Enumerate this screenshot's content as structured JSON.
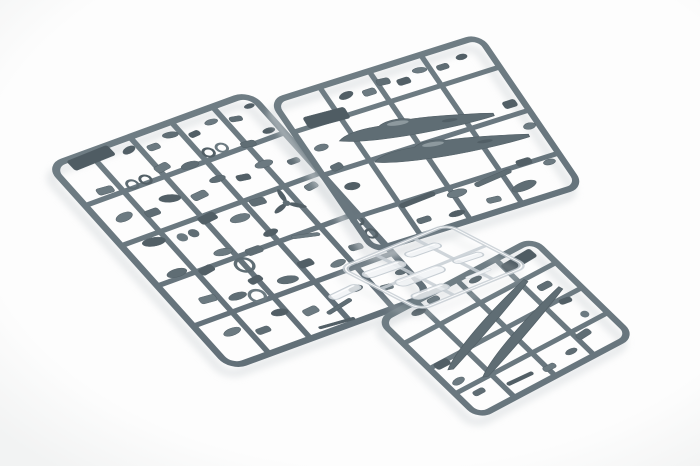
{
  "image": {
    "kind": "photograph",
    "subject": "injection-molded plastic scale-model aircraft kit sprues on a white studio background",
    "width": 700,
    "height": 466
  },
  "palette": {
    "bg_center": "#fdfdfd",
    "bg_edge": "#f2f3f3",
    "runner_top": "#6f7d84",
    "runner_bottom": "#596670",
    "part": "#5f6d74",
    "part_dark": "#525f66",
    "part_light": "#6c7a81",
    "tab": "#4f5c63",
    "accent_light": "#8d999e",
    "clear_stroke": "#c7ced4",
    "clear_fill": "#f0f3f5",
    "clear_highlight": "#ffffff",
    "shadow": "#d7dbde"
  },
  "sprues": [
    {
      "name": "sprue-a-detail-parts",
      "material": "grey-styrene",
      "matrix": [
        0.94,
        -0.344,
        0.668,
        0.744,
        45,
        165
      ],
      "frame": {
        "w": 218,
        "h": 277,
        "rx": 14,
        "stroke": 7
      },
      "runners": {
        "v": [
          44,
          88,
          132,
          176
        ],
        "h": [
          56,
          110,
          164,
          218
        ]
      },
      "parts": [
        [
          "tab",
          42,
          10,
          44,
          13,
          -2
        ],
        [
          "ell",
          78,
          16,
          14,
          7,
          -15
        ],
        [
          "rect",
          100,
          22,
          12,
          7,
          0
        ],
        [
          "ell",
          122,
          16,
          15,
          7,
          10
        ],
        [
          "rect",
          142,
          24,
          11,
          6,
          -5
        ],
        [
          "ell",
          164,
          18,
          13,
          6,
          0
        ],
        [
          "rect",
          186,
          24,
          12,
          6,
          12
        ],
        [
          "ell",
          206,
          16,
          10,
          5,
          0
        ],
        [
          "rect",
          30,
          48,
          16,
          8,
          5
        ],
        [
          "ring",
          56,
          52,
          5,
          2.5,
          0
        ],
        [
          "ring",
          70,
          52,
          5,
          2.5,
          0
        ],
        [
          "rect",
          92,
          46,
          15,
          8,
          -8
        ],
        [
          "ell",
          116,
          54,
          18,
          8,
          0
        ],
        [
          "ring",
          140,
          48,
          5,
          2.5,
          0
        ],
        [
          "ring",
          154,
          48,
          5,
          2.5,
          0
        ],
        [
          "rect",
          178,
          54,
          14,
          7,
          8
        ],
        [
          "ell",
          204,
          48,
          12,
          6,
          0
        ],
        [
          "ell",
          26,
          82,
          18,
          9,
          -10
        ],
        [
          "rect",
          52,
          88,
          14,
          8,
          0
        ],
        [
          "ell",
          76,
          80,
          20,
          9,
          15
        ],
        [
          "rect",
          102,
          88,
          16,
          8,
          -5
        ],
        [
          "ell",
          128,
          78,
          16,
          7,
          0
        ],
        [
          "rect",
          150,
          86,
          13,
          7,
          10
        ],
        [
          "ell",
          176,
          80,
          18,
          8,
          0
        ],
        [
          "rect",
          202,
          88,
          12,
          6,
          0
        ],
        [
          "ell",
          32,
          118,
          22,
          10,
          8
        ],
        [
          "disc",
          58,
          124,
          5,
          0,
          0
        ],
        [
          "disc",
          70,
          124,
          5,
          0,
          0
        ],
        [
          "rect",
          92,
          114,
          18,
          9,
          -6
        ],
        [
          "ell",
          118,
          126,
          20,
          9,
          0
        ],
        [
          "rect",
          144,
          116,
          15,
          8,
          5
        ],
        [
          "prop",
          166,
          128,
          17,
          0,
          0
        ],
        [
          "rect",
          198,
          120,
          13,
          7,
          -8
        ],
        [
          "ell",
          28,
          158,
          20,
          9,
          0
        ],
        [
          "rect",
          54,
          166,
          15,
          8,
          -10
        ],
        [
          "ell",
          80,
          154,
          18,
          8,
          6
        ],
        [
          "rect",
          106,
          164,
          16,
          8,
          0
        ],
        [
          "ell",
          132,
          152,
          15,
          7,
          -5
        ],
        [
          "rod",
          158,
          168,
          26,
          4,
          15
        ],
        [
          "ring",
          88,
          175,
          8,
          3,
          0
        ],
        [
          "ring",
          210,
          172,
          5,
          2.5,
          0
        ],
        [
          "rect",
          34,
          196,
          16,
          8,
          5
        ],
        [
          "ell",
          60,
          204,
          18,
          8,
          0
        ],
        [
          "rect",
          86,
          194,
          14,
          7,
          -8
        ],
        [
          "ring",
          76,
          211,
          7,
          3,
          0
        ],
        [
          "ell",
          112,
          206,
          20,
          9,
          10
        ],
        [
          "rect",
          138,
          196,
          15,
          8,
          0
        ],
        [
          "ell",
          164,
          208,
          16,
          7,
          -6
        ],
        [
          "rect",
          190,
          198,
          13,
          7,
          5
        ],
        [
          "ring",
          212,
          190,
          5,
          2.5,
          0
        ],
        [
          "ell",
          30,
          238,
          18,
          8,
          -5
        ],
        [
          "rect",
          56,
          248,
          14,
          7,
          0
        ],
        [
          "ell",
          82,
          236,
          16,
          8,
          8
        ],
        [
          "rect",
          108,
          246,
          15,
          8,
          -5
        ],
        [
          "rod",
          134,
          252,
          30,
          4,
          -12
        ],
        [
          "ell",
          160,
          240,
          14,
          7,
          0
        ],
        [
          "rect",
          186,
          250,
          12,
          6,
          6
        ],
        [
          "ell",
          208,
          240,
          11,
          6,
          0
        ],
        [
          "rod",
          120,
          268,
          36,
          3,
          5
        ]
      ]
    },
    {
      "name": "sprue-b-fuselage-halves",
      "material": "grey-styrene",
      "matrix": [
        0.955,
        -0.302,
        0.565,
        0.828,
        268,
        100
      ],
      "frame": {
        "w": 222,
        "h": 186,
        "rx": 12,
        "stroke": 6.5
      },
      "runners": {
        "v": [
          52,
          104,
          158
        ],
        "h": [
          40,
          92,
          144
        ]
      },
      "parts": [
        [
          "tab",
          40,
          36,
          42,
          13,
          3
        ],
        [
          "ell",
          70,
          20,
          15,
          7,
          -10
        ],
        [
          "rect",
          92,
          24,
          13,
          7,
          0
        ],
        [
          "rect",
          110,
          18,
          13,
          7,
          5
        ],
        [
          "rect",
          128,
          24,
          13,
          7,
          0
        ],
        [
          "ell",
          148,
          18,
          14,
          6,
          8
        ],
        [
          "rect",
          170,
          22,
          12,
          6,
          0
        ],
        [
          "ell",
          192,
          18,
          11,
          6,
          0
        ],
        [
          "ell",
          18,
          64,
          14,
          7,
          0
        ],
        [
          "rect",
          20,
          88,
          12,
          7,
          -8
        ],
        [
          "ell",
          22,
          112,
          15,
          8,
          5
        ],
        [
          "fus",
          112,
          72,
          150,
          24,
          9
        ],
        [
          "fus",
          130,
          104,
          150,
          24,
          9
        ],
        [
          "rod",
          70,
          146,
          38,
          5,
          -4
        ],
        [
          "ell",
          108,
          152,
          20,
          8,
          0
        ],
        [
          "rod",
          148,
          148,
          40,
          5,
          -6
        ],
        [
          "rect",
          184,
          142,
          15,
          7,
          0
        ],
        [
          "ell",
          206,
          150,
          12,
          6,
          0
        ],
        [
          "rect",
          64,
          168,
          14,
          6,
          0
        ],
        [
          "ell",
          96,
          172,
          16,
          6,
          0
        ],
        [
          "rect",
          136,
          170,
          14,
          6,
          5
        ],
        [
          "ell",
          170,
          166,
          26,
          9,
          -5
        ],
        [
          "rect",
          206,
          80,
          13,
          8,
          0
        ],
        [
          "ell",
          210,
          108,
          12,
          7,
          0
        ]
      ]
    },
    {
      "name": "sprue-c-wing-halves",
      "material": "grey-styrene",
      "matrix": [
        0.883,
        -0.469,
        0.717,
        0.696,
        375,
        320
      ],
      "frame": {
        "w": 179,
        "h": 144,
        "rx": 12,
        "stroke": 6.5
      },
      "runners": {
        "v": [
          44,
          90,
          134
        ],
        "h": [
          36,
          72,
          108
        ]
      },
      "parts": [
        [
          "tab",
          150,
          16,
          34,
          11,
          -3
        ],
        [
          "ell",
          38,
          14,
          14,
          7,
          5
        ],
        [
          "rect",
          58,
          10,
          12,
          6,
          0
        ],
        [
          "ell",
          104,
          12,
          13,
          6,
          0
        ],
        [
          "wing",
          78,
          60,
          132,
          17,
          -16
        ],
        [
          "wing",
          98,
          84,
          132,
          17,
          -16
        ],
        [
          "rect",
          150,
          52,
          14,
          7,
          0
        ],
        [
          "rect",
          154,
          76,
          12,
          6,
          8
        ],
        [
          "disc",
          158,
          98,
          4,
          0,
          0
        ],
        [
          "rect",
          142,
          116,
          15,
          7,
          -5
        ],
        [
          "rect",
          16,
          74,
          15,
          8,
          0
        ],
        [
          "ell",
          15,
          98,
          13,
          7,
          -6
        ],
        [
          "rect",
          22,
          118,
          12,
          6,
          0
        ],
        [
          "rod",
          62,
          126,
          28,
          4,
          3
        ],
        [
          "rect",
          92,
          130,
          13,
          6,
          0
        ],
        [
          "ell",
          120,
          126,
          12,
          6,
          0
        ]
      ]
    },
    {
      "name": "sprue-d-clear-canopy",
      "material": "clear",
      "matrix": [
        0.926,
        -0.38,
        0.888,
        0.46,
        335,
        268
      ],
      "frame": {
        "w": 121,
        "h": 96,
        "rx": 10,
        "stroke": 5
      },
      "runners": {
        "v": [
          40,
          82
        ],
        "h": [
          48
        ]
      },
      "parts": [
        [
          "can",
          28,
          26,
          40,
          11,
          4
        ],
        [
          "can",
          74,
          22,
          34,
          9,
          4
        ],
        [
          "can",
          42,
          52,
          48,
          12,
          2
        ],
        [
          "can",
          92,
          54,
          28,
          8,
          6
        ],
        [
          "can",
          30,
          76,
          36,
          10,
          2
        ],
        [
          "rod",
          80,
          78,
          26,
          4,
          0
        ],
        [
          "can",
          -22,
          34,
          32,
          9,
          -4
        ]
      ]
    }
  ]
}
